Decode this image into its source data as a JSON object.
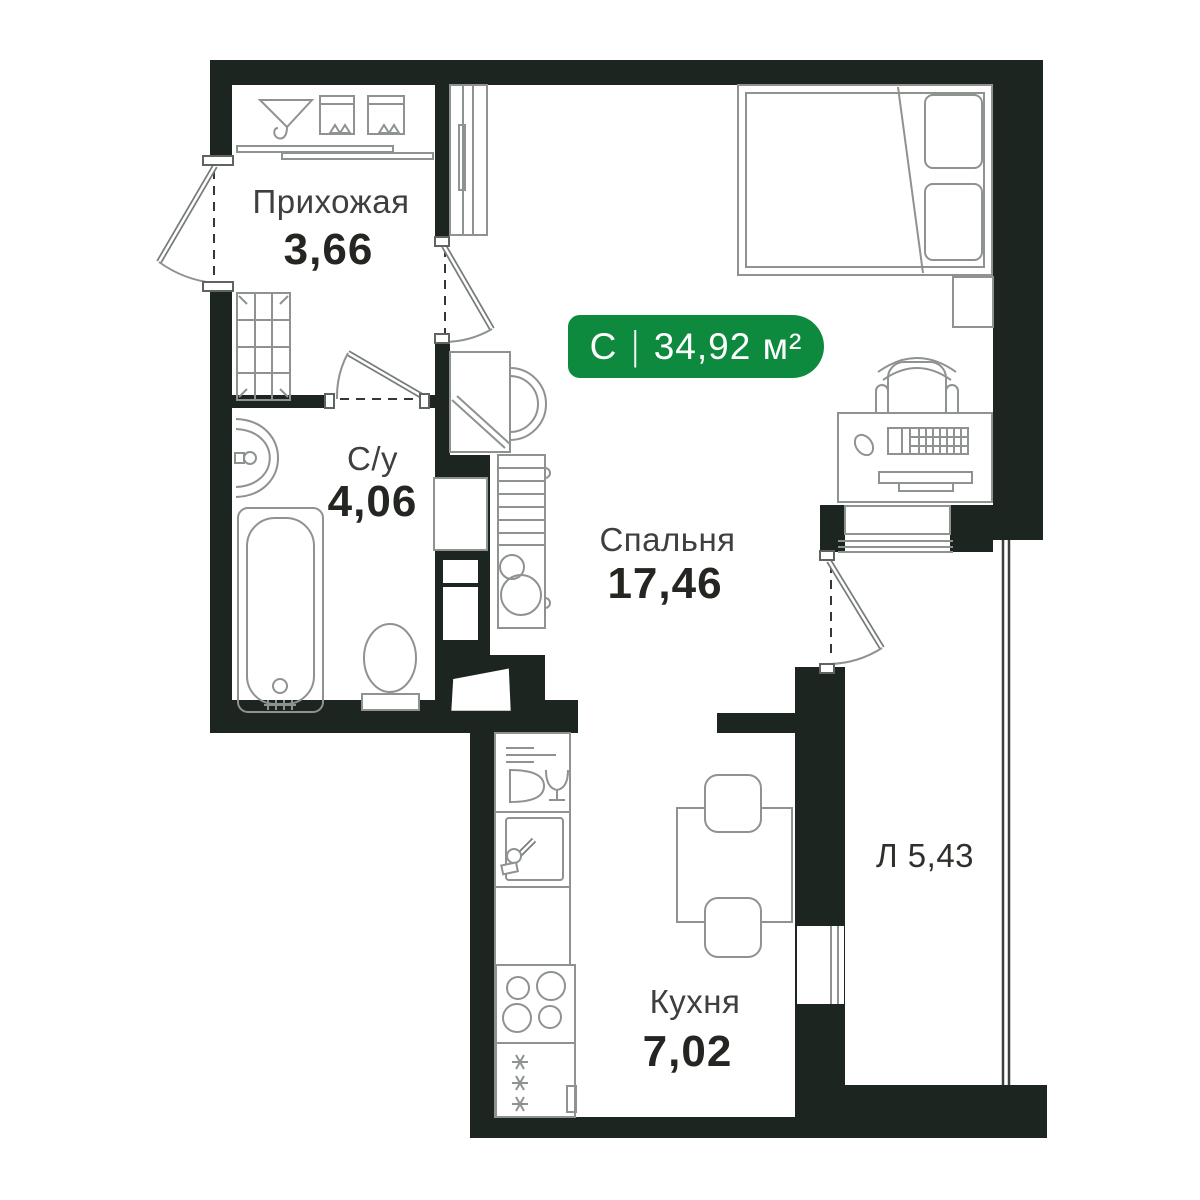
{
  "plan": {
    "badge": {
      "type_label": "С",
      "separator": "|",
      "area_text": "34,92 м²"
    },
    "rooms": {
      "hallway": {
        "name": "Прихожая",
        "area": "3,66"
      },
      "bathroom": {
        "name": "С/у",
        "area": "4,06"
      },
      "bedroom": {
        "name": "Спальня",
        "area": "17,46"
      },
      "kitchen": {
        "name": "Кухня",
        "area": "7,02"
      },
      "loggia": {
        "label": "Л 5,43"
      }
    },
    "icons": [
      "hanger-icon",
      "storage-box-icon",
      "sliding-door-track",
      "wardrobe-icon",
      "shoe-cabinet-icon",
      "entrance-door-icon",
      "interior-door-icon",
      "balcony-door-icon",
      "bath-sink-icon",
      "bathtub-icon",
      "toilet-icon",
      "washing-machine-icon",
      "shelving-icon",
      "water-heater-icon",
      "vent-hatch-icon",
      "dish-rack-icon",
      "kitchen-sink-icon",
      "stove-icon",
      "fridge-icon",
      "snowflake-icon",
      "dining-table-icon",
      "chair-icon",
      "bed-icon",
      "pillow-icon",
      "nightstand-icon",
      "desk-icon",
      "keyboard-icon",
      "mouse-icon",
      "monitor-icon",
      "desk-chair-icon",
      "window-icon",
      "loggia-glazing"
    ],
    "colors": {
      "wall": "#1d2521",
      "line": "#8e938f",
      "badge": "#0e8a3e",
      "text_name": "#3e403d",
      "text_number": "#242622"
    }
  }
}
